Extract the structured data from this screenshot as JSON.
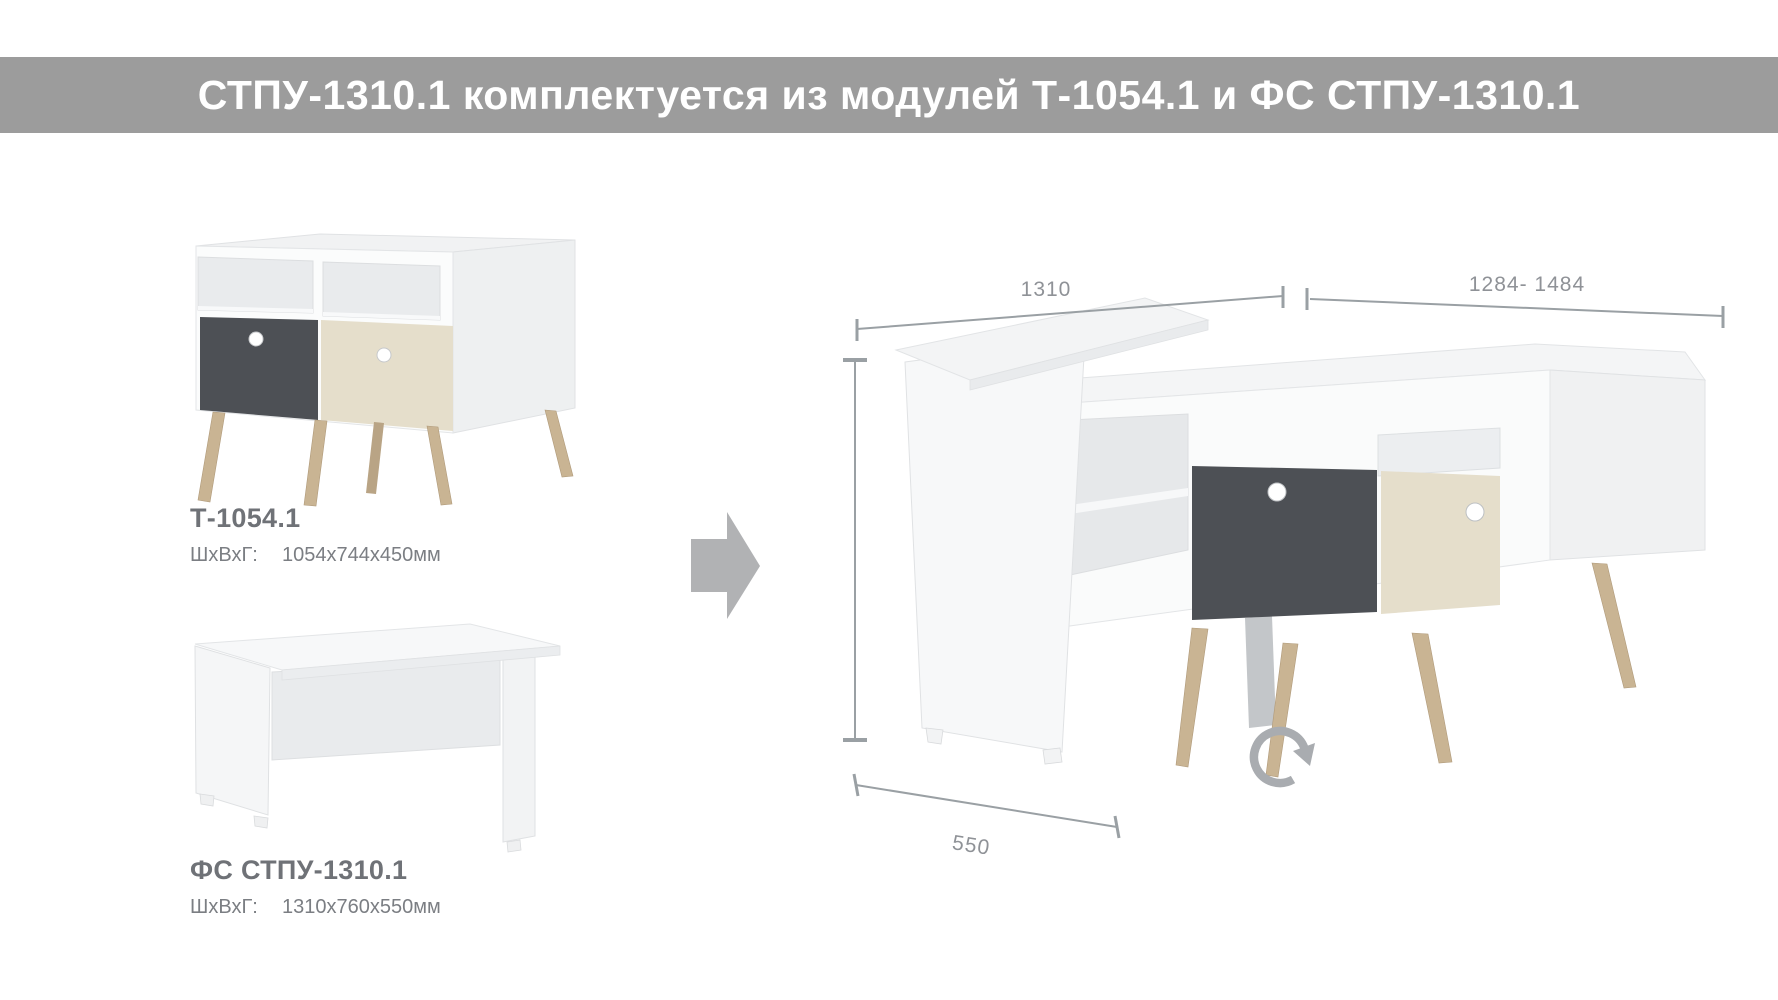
{
  "banner": {
    "title": "СТПУ-1310.1 комплектуется из модулей Т-1054.1 и ФС СТПУ-1310.1",
    "bg_color": "#9c9c9c",
    "text_color": "#ffffff"
  },
  "modules": [
    {
      "name": "Т-1054.1",
      "dims_label": "ШхВхГ:",
      "dims_value": "1054х744х450мм"
    },
    {
      "name": "ФС СТПУ-1310.1",
      "dims_label": "ШхВхГ:",
      "dims_value": "1310х760х550мм"
    }
  ],
  "assembled": {
    "dim_width_desk": "1310",
    "dim_width_cabinet": "1284- 1484",
    "dim_depth": "550"
  },
  "icons": {
    "arrow_right": "right-arrow",
    "rotate": "rotate-clockwise"
  },
  "colors": {
    "banner_bg": "#9c9c9c",
    "drawer_dark": "#4d5055",
    "drawer_beige": "#e5decb",
    "leg_wood": "#c9b493",
    "leg_wood_dark": "#b9a485",
    "dim_gray": "#9aa0a4",
    "text_gray": "#6f7277",
    "arrow_gray": "#b1b2b4"
  }
}
